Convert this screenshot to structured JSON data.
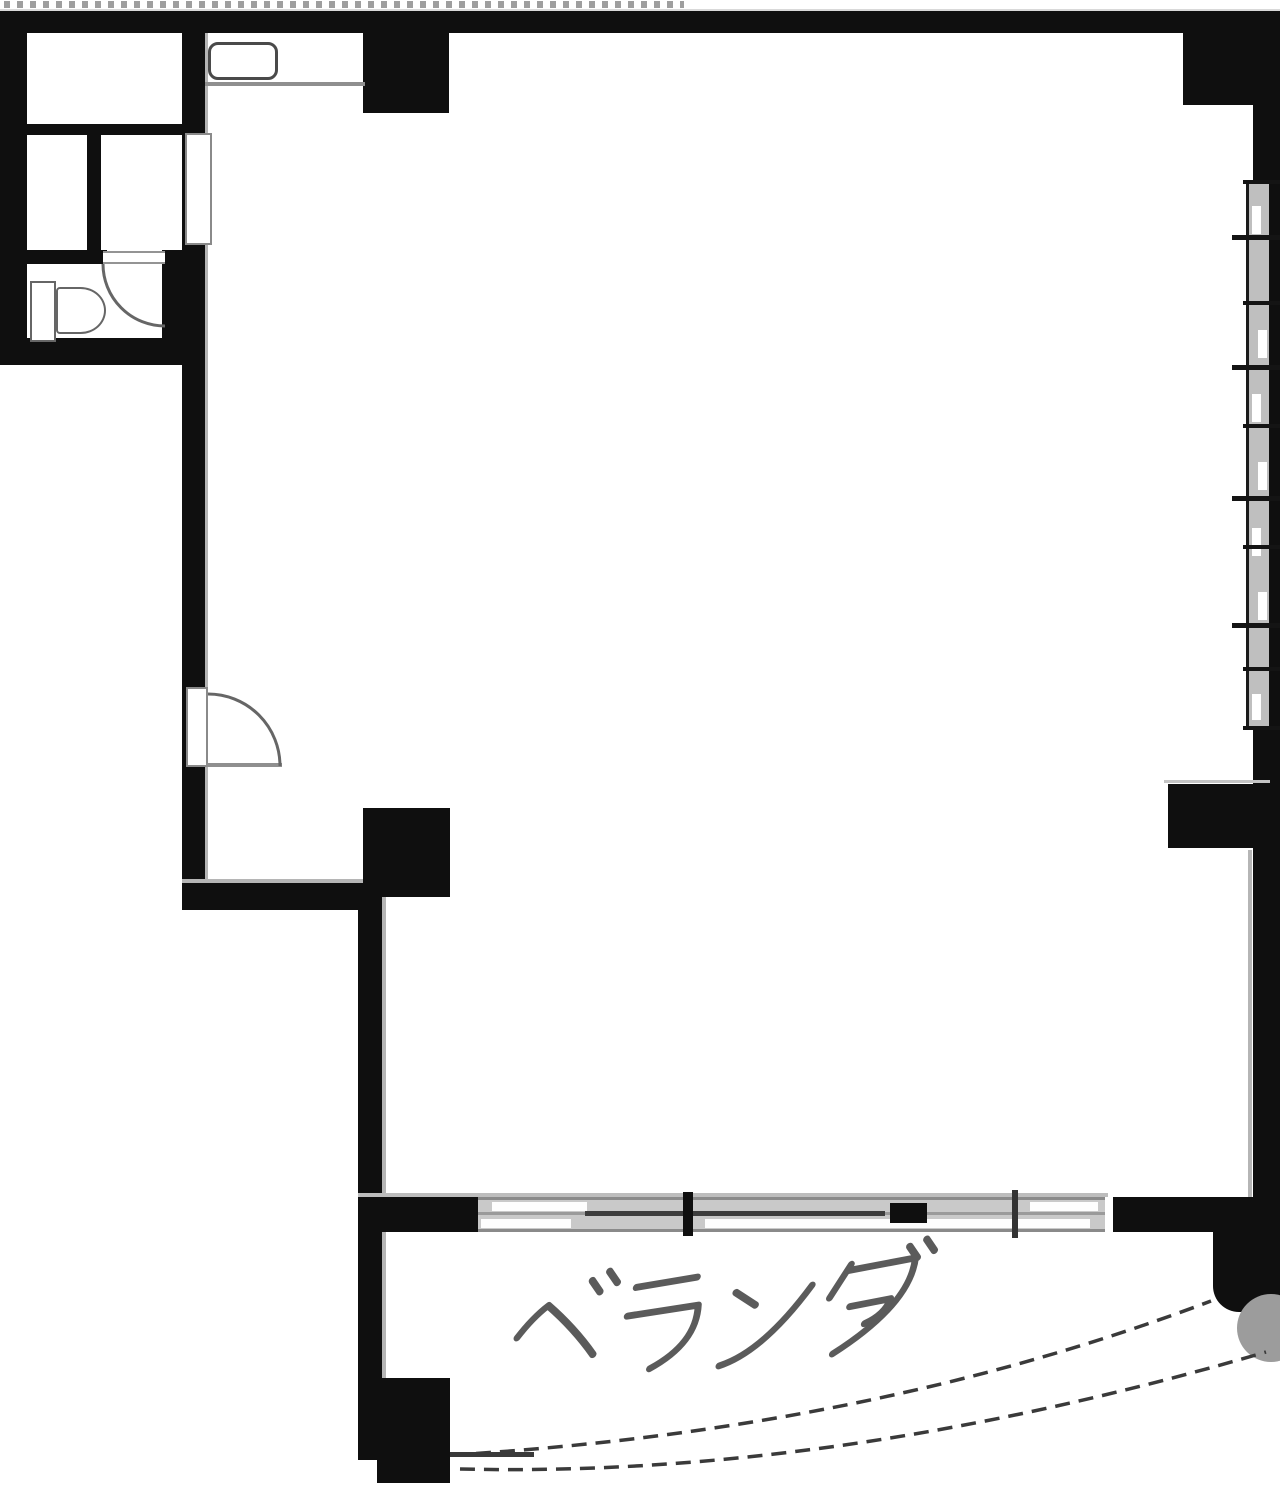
{
  "plan": {
    "balcony": {
      "label": "ベランダ"
    }
  },
  "colors": {
    "paper": "#ffffff",
    "wall": "#0f0f0f",
    "hairline": "#b5b5b5",
    "fixture-stroke": "#666666",
    "door-stroke": "#8a8a8a",
    "window-fill": "#bfbfbf",
    "track-fill": "#c9c9c9",
    "dash": "#3a3a3a",
    "disc": "#9c9c9c",
    "label-ink": "#3f3f3f",
    "dots": "#9e9e9e"
  }
}
